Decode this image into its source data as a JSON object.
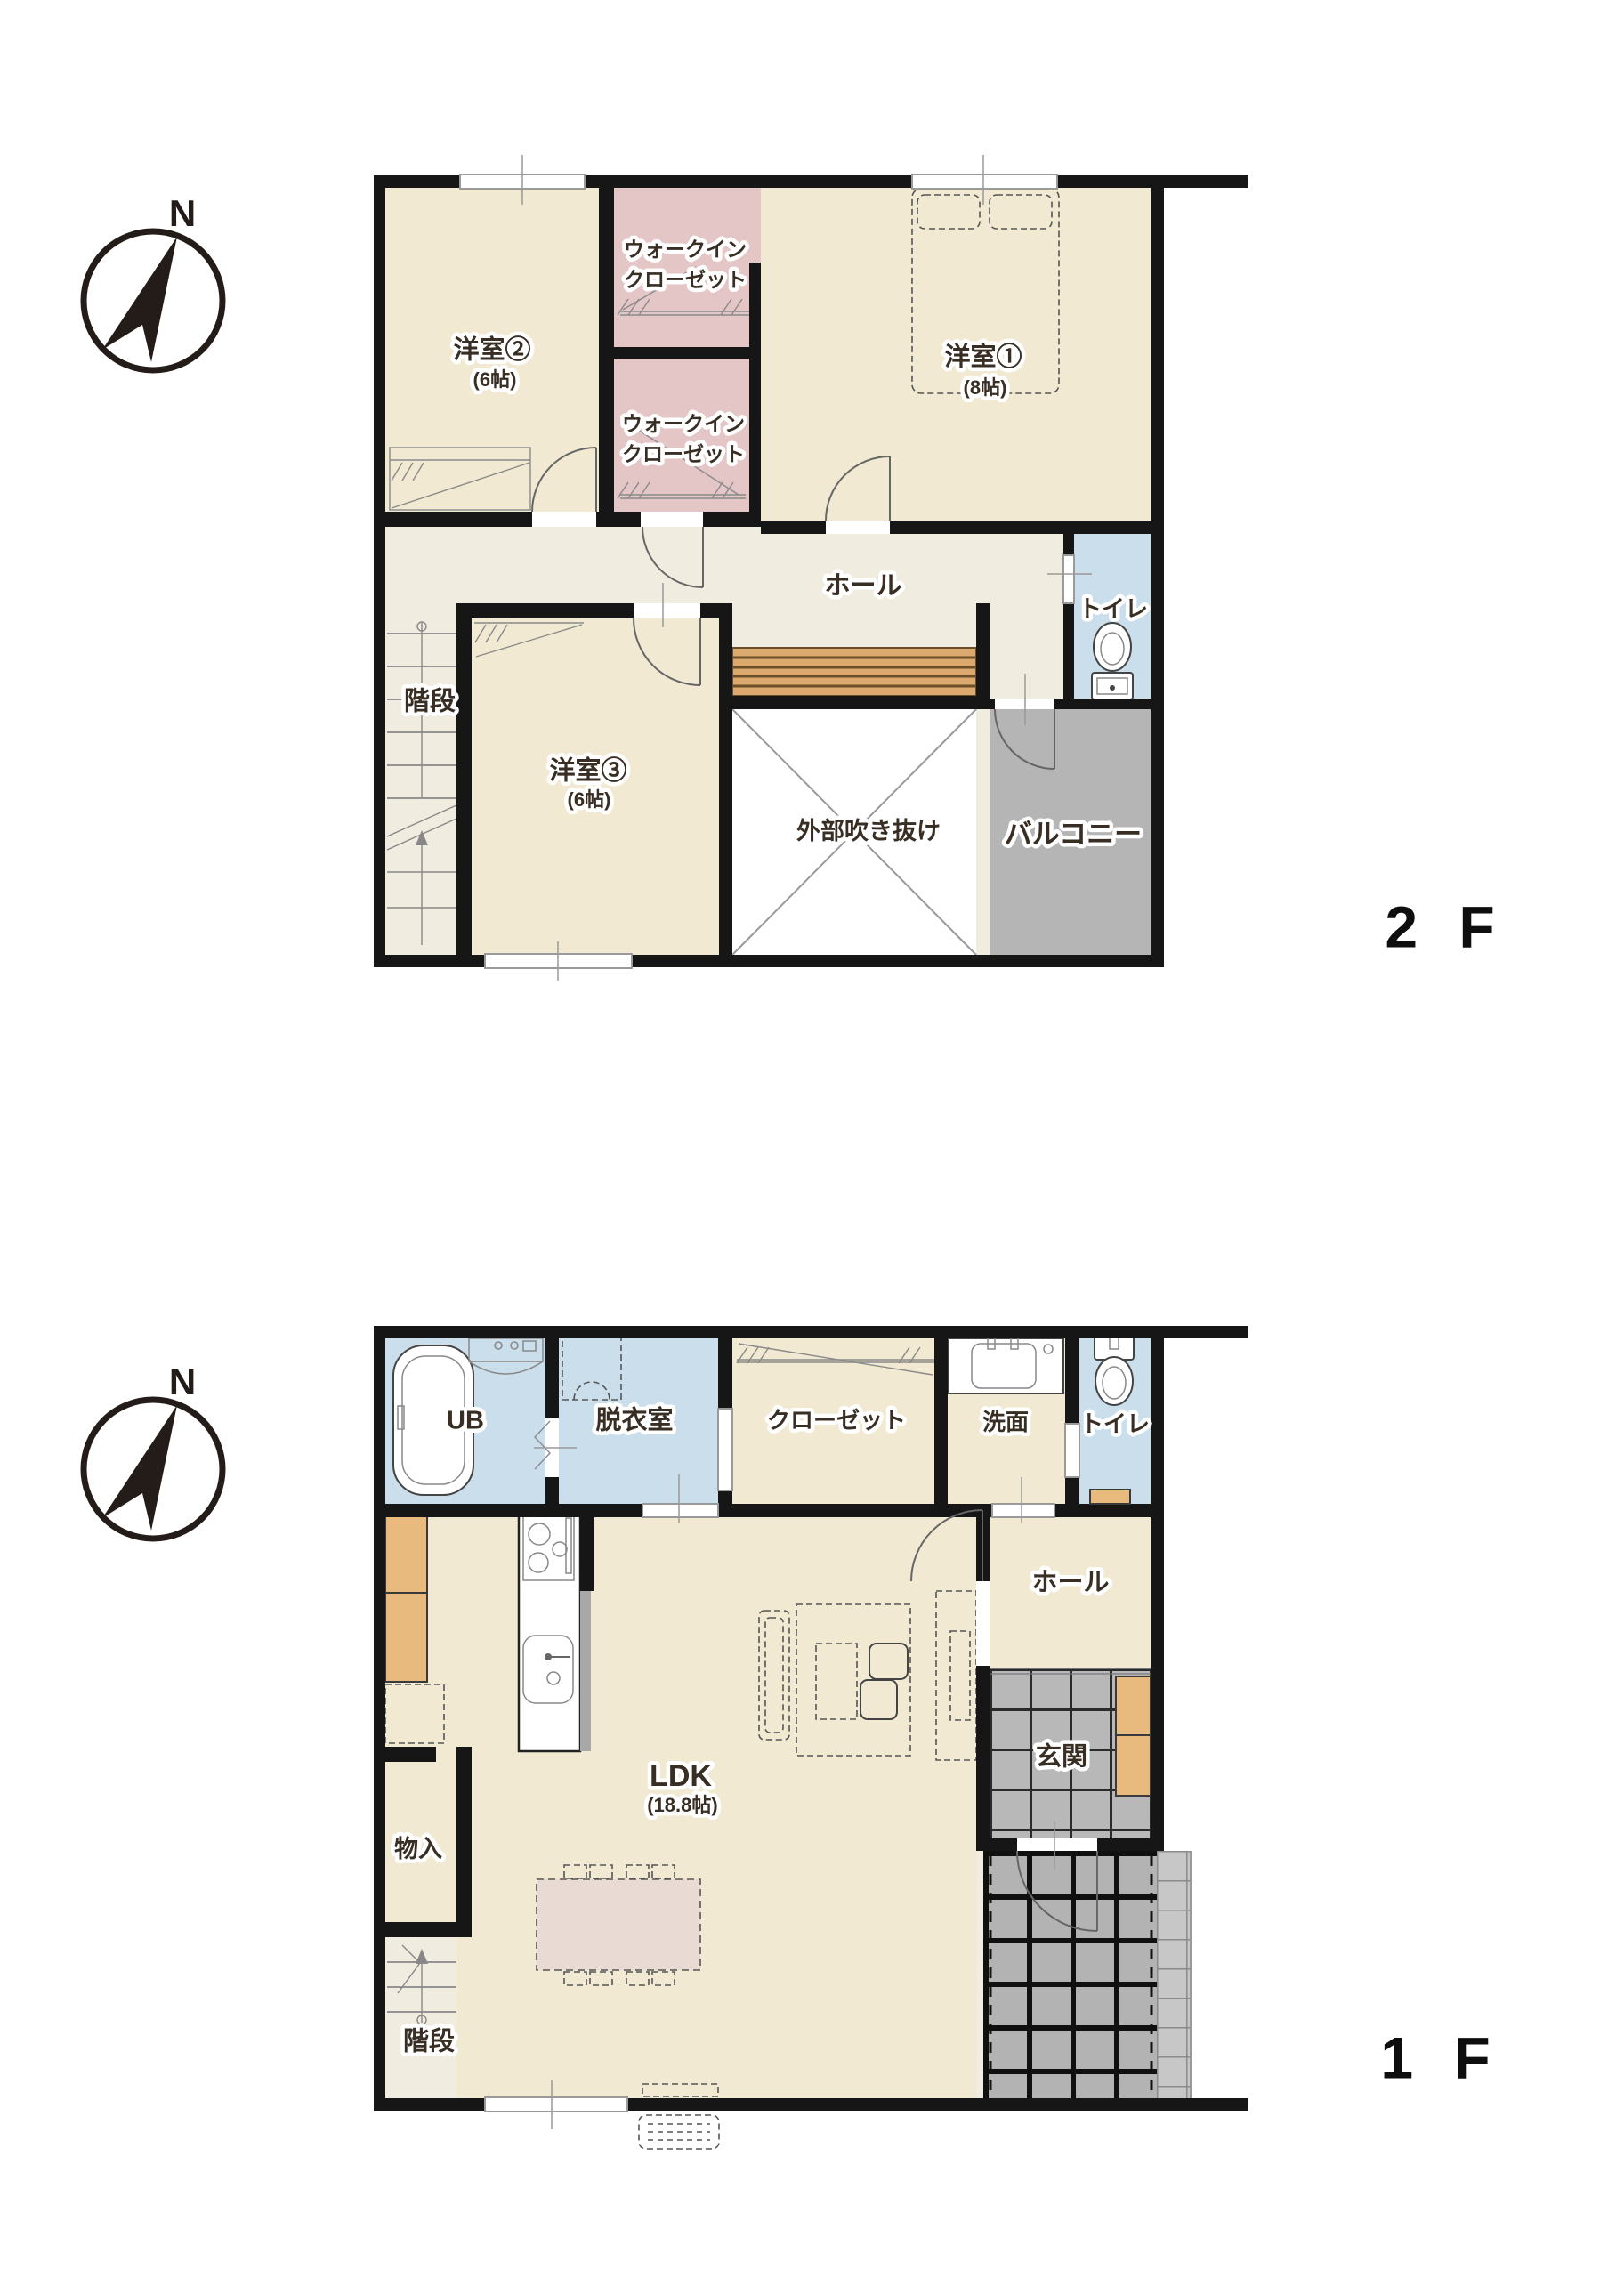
{
  "colors": {
    "wall": "#161616",
    "base": "#f1ece0",
    "room": "#f1e9d2",
    "pink": "#e5c6c7",
    "blue": "#cbdeec",
    "gray": "#b5b5b5",
    "tile": "#b8b8b8",
    "wood": "#dcaa6e",
    "cab": "#e9ba7e",
    "table": "#eadad4",
    "text": "#382e24"
  },
  "floor2": {
    "floor_label": "2 F",
    "compass": {
      "north": "N"
    },
    "rooms": {
      "yoshitsu2": {
        "label": "洋室②",
        "size": "(6帖)"
      },
      "wic_upper": {
        "line1": "ウォークイン",
        "line2": "クローゼット"
      },
      "wic_lower": {
        "line1": "ウォークイン",
        "line2": "クローゼット"
      },
      "yoshitsu1": {
        "label": "洋室①",
        "size": "(8帖)"
      },
      "hall": {
        "label": "ホール"
      },
      "toilet": {
        "label": "トイレ"
      },
      "stairs": {
        "label": "階段"
      },
      "yoshitsu3": {
        "label": "洋室③",
        "size": "(6帖)"
      },
      "void": {
        "label": "外部吹き抜け"
      },
      "balcony": {
        "label": "バルコニー"
      }
    }
  },
  "floor1": {
    "floor_label": "1 F",
    "compass": {
      "north": "N"
    },
    "rooms": {
      "ub": {
        "label": "UB"
      },
      "dressing": {
        "label": "脱衣室"
      },
      "closet": {
        "label": "クローゼット"
      },
      "washroom": {
        "label": "洗面"
      },
      "toilet": {
        "label": "トイレ"
      },
      "hall": {
        "label": "ホール"
      },
      "ldk": {
        "label": "LDK",
        "size": "(18.8帖)"
      },
      "genkan": {
        "label": "玄関"
      },
      "storage": {
        "label": "物入"
      },
      "stairs": {
        "label": "階段"
      }
    }
  }
}
